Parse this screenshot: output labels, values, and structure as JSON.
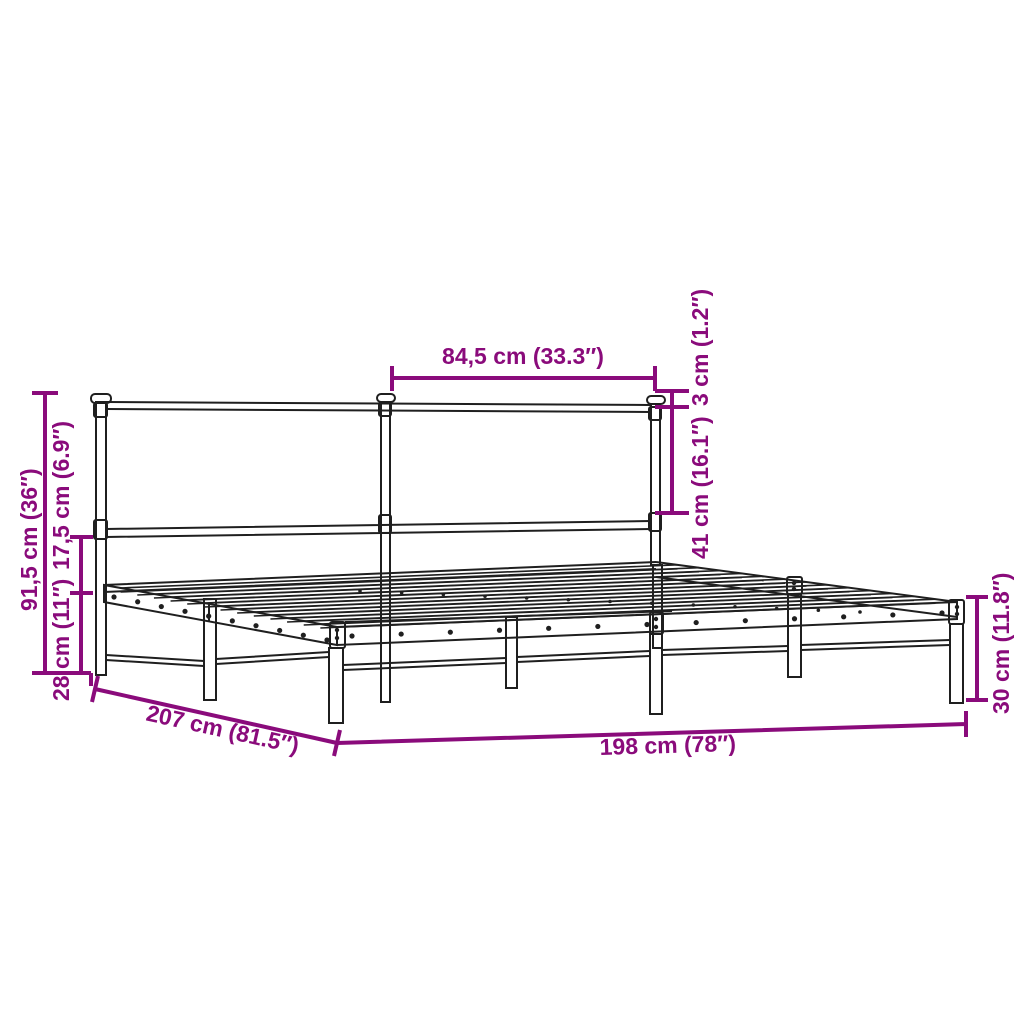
{
  "diagram": {
    "kind": "product-dimension-diagram",
    "subject": "metal bed frame with headboard",
    "colors": {
      "accent": "#8A0B7B",
      "line": "#1F1F1F",
      "background": "#FFFFFF"
    },
    "dimensions": {
      "headboard_section_width": "84,5 cm (33.3″)",
      "finial_height": "3 cm (1.2″)",
      "headboard_panel_height": "41 cm (16.1″)",
      "overall_height": "91,5 cm (36″)",
      "rail_to_base_gap": "17,5 cm (6.9″)",
      "under_bed_clearance": "28 cm (11″)",
      "frame_length": "207 cm (81.5″)",
      "frame_width": "198 cm (78″)",
      "foot_end_height": "30 cm (11.8″)"
    }
  }
}
